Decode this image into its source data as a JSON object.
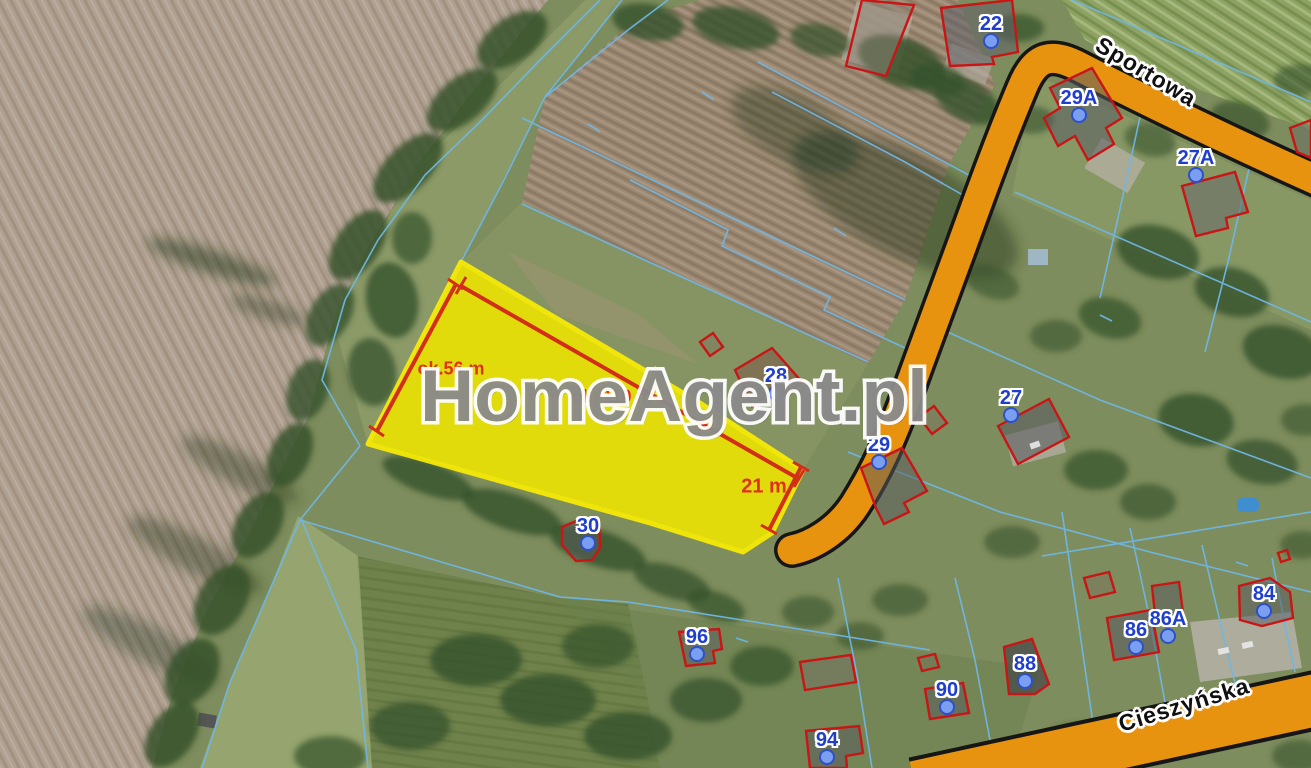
{
  "map": {
    "watermark": "HomeAgent.pl",
    "streets": {
      "sportowa": "Sportowa",
      "cieszynska": "Cieszyńska"
    },
    "measurements": {
      "side": "ok.56 m",
      "length": "ok. 110 m",
      "width": "21 m"
    },
    "houses": [
      {
        "number": "22"
      },
      {
        "number": "29A"
      },
      {
        "number": "27A"
      },
      {
        "number": "28"
      },
      {
        "number": "27"
      },
      {
        "number": "29"
      },
      {
        "number": "30"
      },
      {
        "number": "96"
      },
      {
        "number": "88"
      },
      {
        "number": "90"
      },
      {
        "number": "94"
      },
      {
        "number": "84"
      },
      {
        "number": "86"
      },
      {
        "number": "86A"
      }
    ],
    "colors": {
      "parcel_highlight": "#f0e600",
      "parcel_border": "#fff200",
      "road": "#e8930f",
      "boundary_line": "#6fb7e6",
      "building_outline": "#c91515",
      "measurement": "#d22f1b",
      "house_label": "#1f3ed0"
    }
  }
}
